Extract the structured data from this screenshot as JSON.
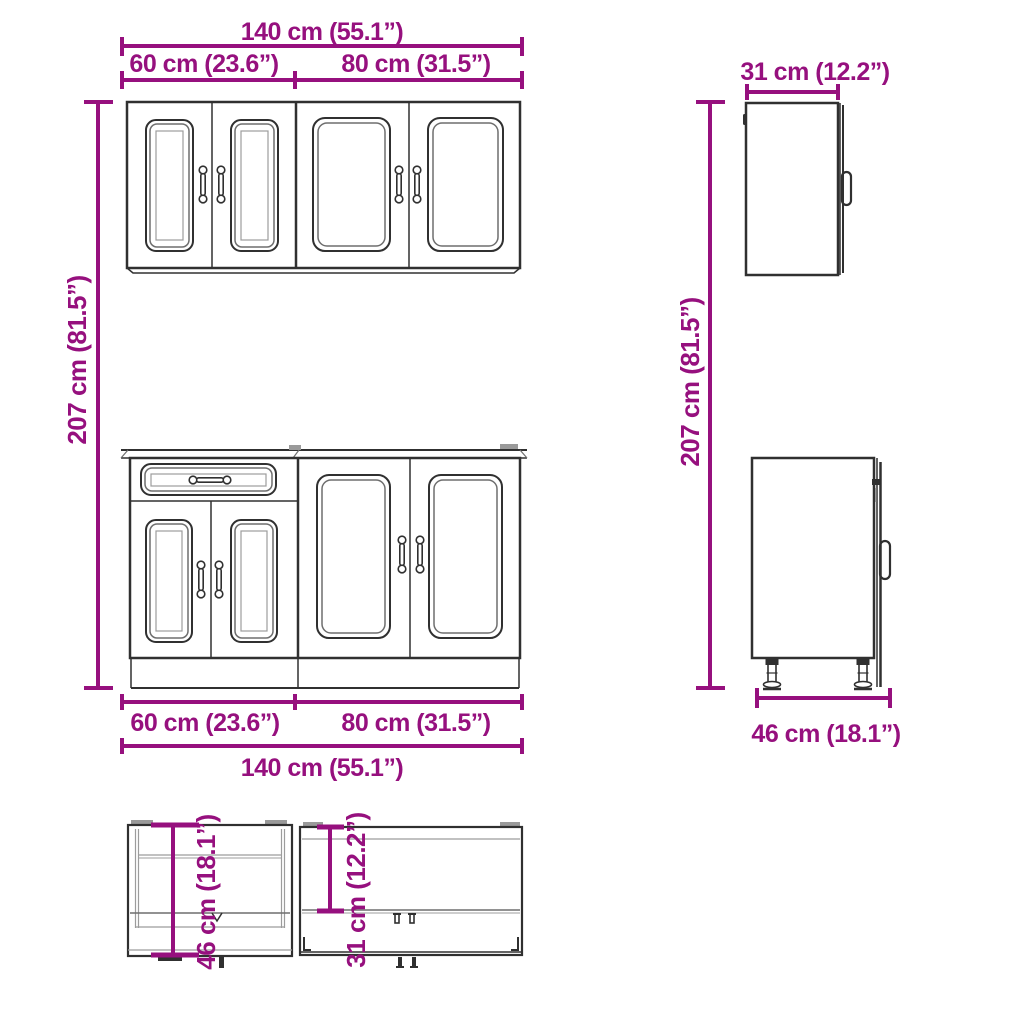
{
  "colors": {
    "dimension": "#96107E",
    "outline": "#303030",
    "detail": "#9c9c9c",
    "background": "#ffffff"
  },
  "dimensions": {
    "wall": {
      "total_width": "140 cm (55.1”)",
      "left_width": "60 cm (23.6”)",
      "right_width": "80 cm (31.5”)",
      "depth": "31 cm (12.2”)",
      "depth_top": "31 cm (12.2”)"
    },
    "base": {
      "total_width": "140 cm (55.1”)",
      "left_width": "60 cm (23.6”)",
      "right_width": "80 cm (31.5”)",
      "depth_side": "46 cm (18.1”)",
      "depth_top": "46 cm (18.1”)"
    },
    "height_left": "207 cm (81.5”)",
    "height_right": "207 cm (81.5”)"
  }
}
